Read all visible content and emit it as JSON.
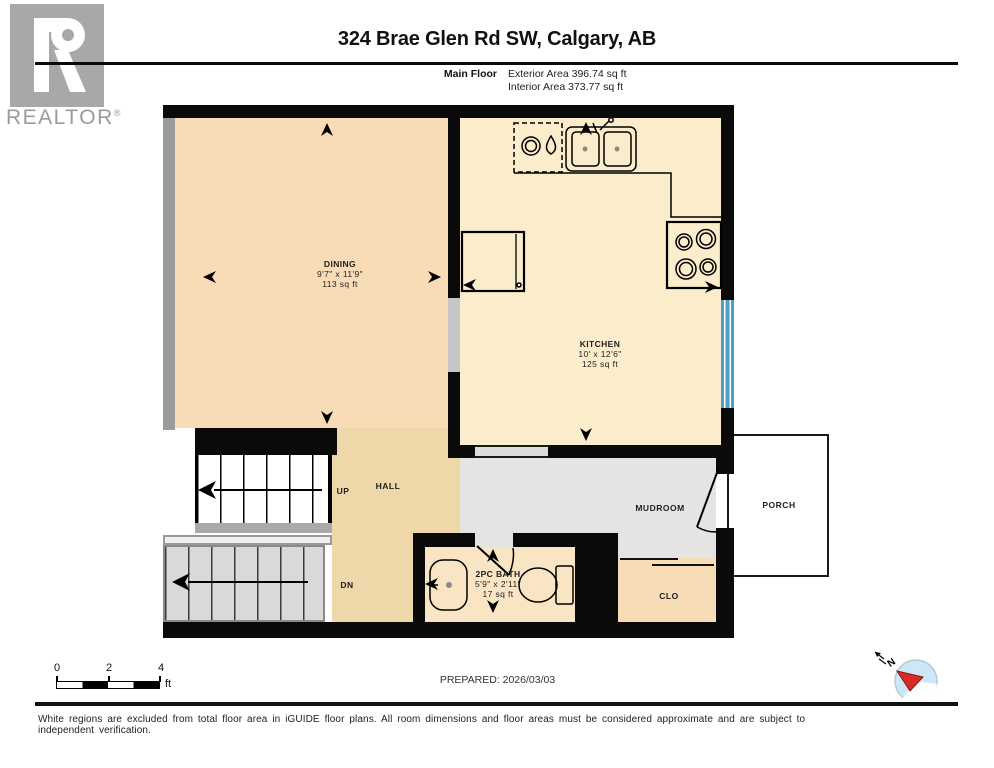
{
  "header": {
    "logo_text": "REALTOR",
    "registered_mark": "®",
    "title": "324 Brae Glen Rd SW, Calgary, AB",
    "floor_label": "Main Floor",
    "exterior_area": "Exterior Area 396.74 sq ft",
    "interior_area": "Interior Area 373.77 sq ft"
  },
  "rooms": {
    "dining": {
      "name": "DINING",
      "dims": "9'7\" x 11'9\"",
      "area": "113 sq ft"
    },
    "kitchen": {
      "name": "KITCHEN",
      "dims": "10' x 12'6\"",
      "area": "125 sq ft"
    },
    "hall": {
      "name": "HALL"
    },
    "stairs_up": {
      "label": "UP"
    },
    "stairs_down": {
      "label": "DN"
    },
    "mudroom": {
      "name": "MUDROOM"
    },
    "porch": {
      "name": "PORCH"
    },
    "bath": {
      "name": "2PC BATH",
      "dims": "5'9\" x 2'11\"",
      "area": "17 sq ft"
    },
    "closet": {
      "name": "CLO"
    }
  },
  "scale_bar": {
    "ticks": [
      "0",
      "2",
      "4"
    ],
    "unit": "ft"
  },
  "compass": {
    "north_label": "N"
  },
  "prepared_label": "PREPARED: 2026/03/03",
  "footer_disclaimer": "White regions are excluded from total floor area in iGUIDE floor plans. All room dimensions and floor areas must be considered approximate and are subject to independent verification.",
  "colors": {
    "wall": "#0a0a0a",
    "shared_wall_gray": "#9b9b9b",
    "dining_floor": "#f8dcb6",
    "kitchen_floor": "#fbeccb",
    "hall_floor": "#eed7a8",
    "mudroom_floor": "#e4e4e3",
    "bath_floor": "#f9e5c3",
    "closet_floor": "#f8dcb6",
    "window_blue": "#4d9fc7",
    "stairs_down_gray": "#d9d9d9",
    "compass_blue": "#cde7f6",
    "compass_red": "#d62b2b",
    "logo_gray": "#a8a8a8"
  }
}
